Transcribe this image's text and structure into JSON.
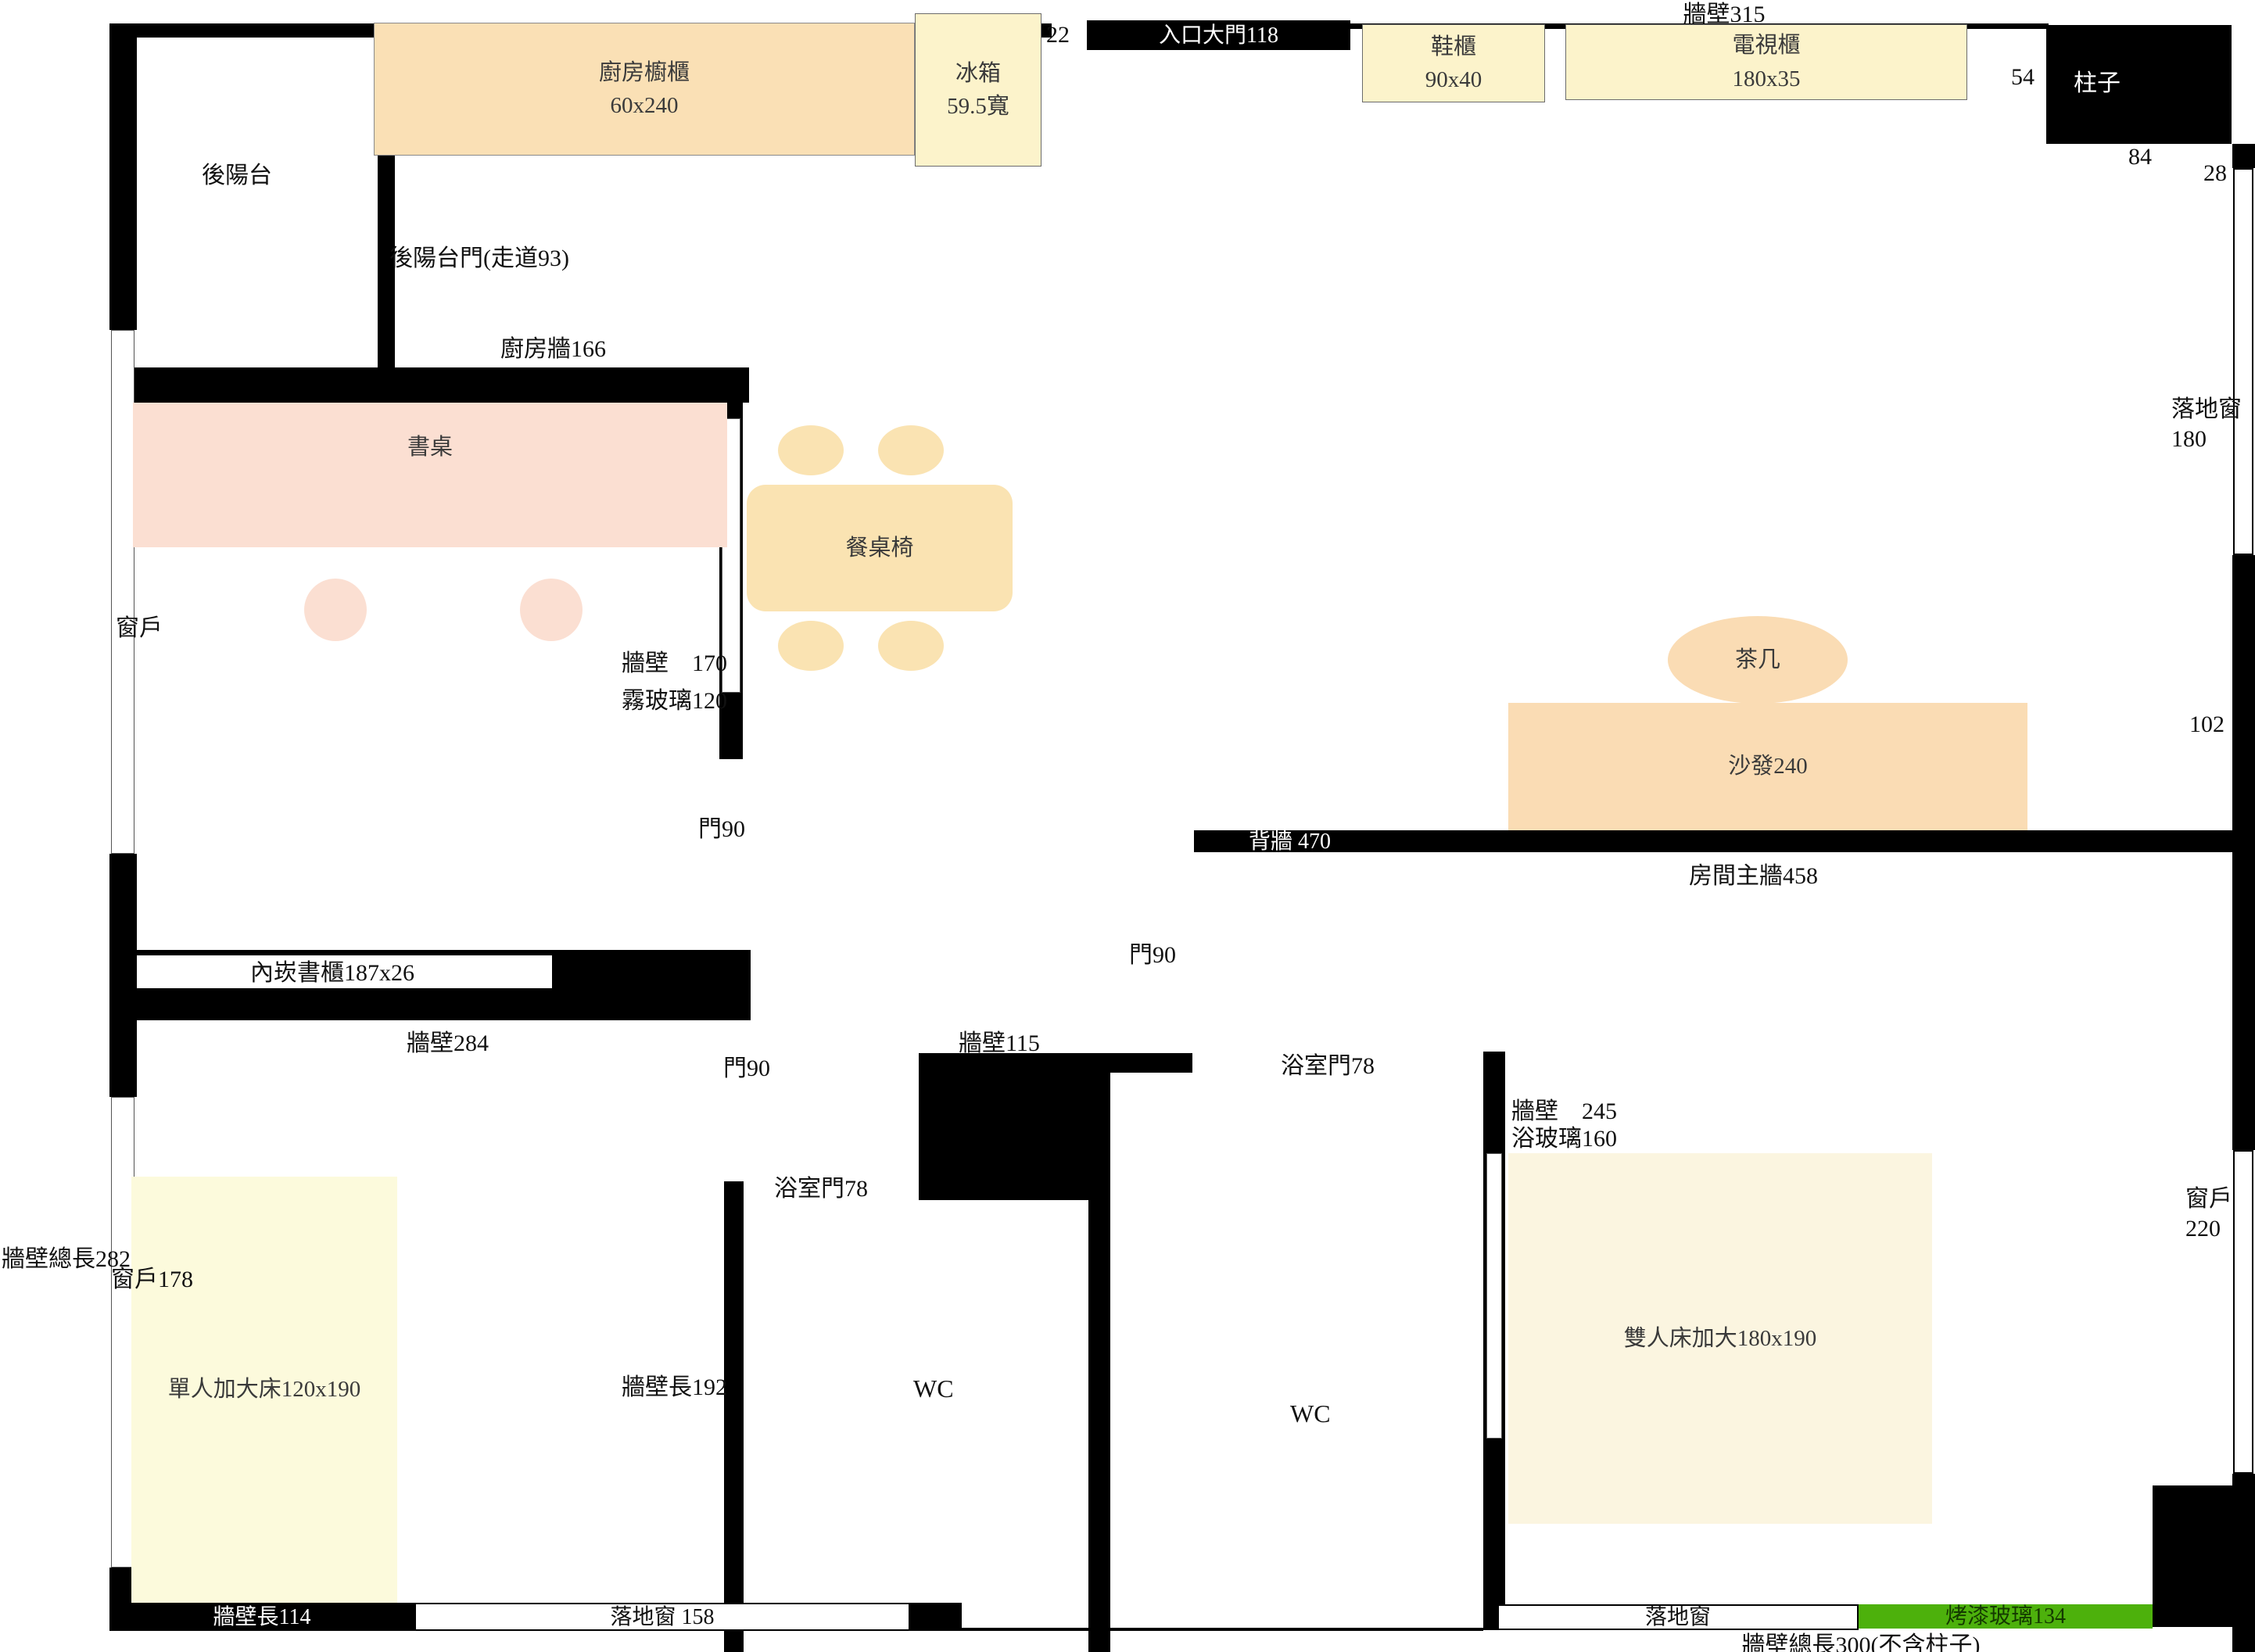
{
  "colors": {
    "wall": "#000000",
    "kitchen_cabinet": "#fae0b5",
    "pale_yellow_cabinet": "#fcf3cb",
    "desk_pink": "#fbdfd2",
    "dining_tan": "#fae3b2",
    "sofa_peach": "#fadcb4",
    "single_bed": "#fcfadc",
    "double_bed": "#fbf5e0",
    "painted_glass_green": "#4db10c"
  },
  "top_edge": {
    "wall_label": "牆壁315",
    "gap_label": "22",
    "entrance_door": "入口大門118",
    "shoe_cabinet_name": "鞋櫃",
    "shoe_cabinet_size": "90x40",
    "tv_cabinet_name": "電視櫃",
    "tv_cabinet_size": "180x35",
    "dim_54": "54",
    "pillar": "柱子",
    "dim_84": "84",
    "dim_28": "28"
  },
  "kitchen": {
    "balcony": "後陽台",
    "cabinet_name": "廚房櫥櫃",
    "cabinet_size": "60x240",
    "fridge_name": "冰箱",
    "fridge_size": "59.5寬",
    "balcony_door": "後陽台門(走道93)",
    "wall": "廚房牆166"
  },
  "study": {
    "desk": "書桌",
    "wall_170": "牆壁　170",
    "frosted_glass": "霧玻璃120",
    "window": "窗戶",
    "door": "門90",
    "bookshelf": "內崁書櫃187x26",
    "wall_284": "牆壁284"
  },
  "dining": {
    "table": "餐桌椅"
  },
  "living": {
    "coffee_table": "茶几",
    "sofa": "沙發240",
    "back_wall": "背牆 470",
    "room_main_wall": "房間主牆458",
    "door": "門90",
    "floor_window_line1": "落地窗",
    "floor_window_line2": "180",
    "dim_102": "102"
  },
  "bedroom1": {
    "bed": "單人加大床120x190",
    "window_label": "窗戶178",
    "outer_wall": "牆壁總長282",
    "door": "門90",
    "wall_192": "牆壁長192",
    "bottom_wall": "牆壁長114",
    "floor_window": "落地窗 158"
  },
  "bathrooms": {
    "wall_115": "牆壁115",
    "door_left": "浴室門78",
    "door_right": "浴室門78",
    "wc_left": "WC",
    "wc_right": "WC",
    "wall_245": "牆壁　245",
    "bath_glass": "浴玻璃160"
  },
  "bedroom2": {
    "bed": "雙人床加大180x190",
    "window_line1": "窗戶",
    "window_line2": "220",
    "floor_window": "落地窗",
    "painted_glass": "烤漆玻璃134",
    "bottom_note": "牆壁總長300(不含柱子)"
  }
}
